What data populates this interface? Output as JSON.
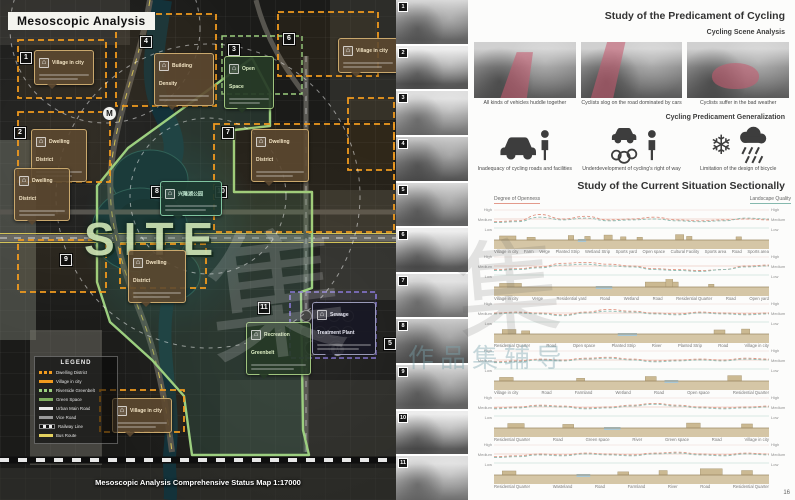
{
  "watermark": {
    "glyph": "集",
    "glyph2": "集",
    "text": "作品集辅导"
  },
  "page_number": "16",
  "map": {
    "title": "Mesoscopic Analysis",
    "site_label": "SITE",
    "metro_label": "M",
    "caption": "Mesoscopic Analysis Comprehensive Status Map  1:17000",
    "legend": {
      "title": "LEGEND",
      "items": [
        {
          "label": "Dwelling District",
          "swatch": "sw-orange-dash"
        },
        {
          "label": "Village in city",
          "swatch": "sw-orange"
        },
        {
          "label": "Riverside Greenbelt",
          "swatch": "sw-green-dash"
        },
        {
          "label": "Green Space",
          "swatch": "sw-green"
        },
        {
          "label": "Urban Main Road",
          "swatch": "sw-white"
        },
        {
          "label": "Vice Road",
          "swatch": "sw-gray"
        },
        {
          "label": "Railway Line",
          "swatch": "sw-rail"
        },
        {
          "label": "Bus Route",
          "swatch": "sw-yellow"
        }
      ]
    },
    "markers": [
      {
        "n": "1",
        "x": 20,
        "y": 52
      },
      {
        "n": "2",
        "x": 14,
        "y": 127
      },
      {
        "n": "3",
        "x": 228,
        "y": 44
      },
      {
        "n": "4",
        "x": 140,
        "y": 36
      },
      {
        "n": "5",
        "x": 384,
        "y": 338
      },
      {
        "n": "6",
        "x": 283,
        "y": 33
      },
      {
        "n": "7",
        "x": 222,
        "y": 127
      },
      {
        "n": "8",
        "x": 151,
        "y": 186
      },
      {
        "n": "9",
        "x": 60,
        "y": 254
      },
      {
        "n": "10",
        "x": 215,
        "y": 186
      },
      {
        "n": "11",
        "x": 258,
        "y": 302
      }
    ],
    "callouts": [
      {
        "t": "Village in city",
        "v": "brown",
        "x": 34,
        "y": 50,
        "w": 50
      },
      {
        "t": "Building Density",
        "v": "brown",
        "x": 154,
        "y": 53,
        "w": 50
      },
      {
        "t": "Open Space",
        "v": "green",
        "x": 224,
        "y": 56,
        "w": 40
      },
      {
        "t": "Village in city",
        "v": "brown",
        "x": 338,
        "y": 38,
        "w": 50
      },
      {
        "t": "Dwelling District",
        "v": "brown",
        "x": 251,
        "y": 129,
        "w": 48
      },
      {
        "t": "Dwelling District",
        "v": "brown",
        "x": 31,
        "y": 129,
        "w": 46
      },
      {
        "t": "Dwelling District",
        "v": "brown",
        "x": 14,
        "y": 168,
        "w": 46
      },
      {
        "t": "兴隆湖公园",
        "v": "jade",
        "x": 160,
        "y": 181,
        "w": 52
      },
      {
        "t": "Dwelling District",
        "v": "brown",
        "x": 128,
        "y": 250,
        "w": 48
      },
      {
        "t": "Recreation Greenbelt",
        "v": "green",
        "x": 246,
        "y": 322,
        "w": 55
      },
      {
        "t": "Sewage Treatment Plant",
        "v": "dark",
        "x": 312,
        "y": 302,
        "w": 54
      },
      {
        "t": "Village in city",
        "v": "brown",
        "x": 112,
        "y": 398,
        "w": 50
      }
    ]
  },
  "photo_strip": {
    "photos": [
      "1",
      "2",
      "3",
      "4",
      "5",
      "6",
      "7",
      "8",
      "9",
      "10",
      "11"
    ]
  },
  "cycling": {
    "title": "Study of the Predicament of Cycling",
    "scene_subtitle": "Cycling Scene Analysis",
    "scenes": [
      {
        "caption": "All kinds of vehicles huddle together"
      },
      {
        "caption": "Cyclists slog on the road dominated by cars"
      },
      {
        "caption": "Cyclists suffer in the bad weather"
      }
    ],
    "generalization_subtitle": "Cycling Predicament Generalization",
    "predicaments": [
      {
        "icon": "car-pedestrian",
        "caption": "Inadequacy of cycling roads and facilities"
      },
      {
        "icon": "car-exhaust-pedestrian",
        "caption": "Underdevelopment of cycling's right of way"
      },
      {
        "icon": "snow-rain",
        "caption": "Limitation of the design of bicycle"
      }
    ]
  },
  "sections_panel": {
    "title": "Study of the Current Situation Sectionally",
    "left_axis": "Degree of Openness",
    "right_axis": "Landscape Quality",
    "levels": [
      "High",
      "Medium",
      "Low"
    ],
    "sections": [
      {
        "openness": [
          0.35,
          0.4,
          0.75,
          0.5,
          0.65,
          0.45,
          0.5,
          0.6,
          0.45,
          0.4,
          0.45,
          0.5,
          0.45
        ],
        "quality": [
          0.3,
          0.35,
          0.6,
          0.45,
          0.55,
          0.4,
          0.45,
          0.5,
          0.4,
          0.35,
          0.4,
          0.55,
          0.5
        ],
        "structures": [
          [
            0.02,
            0.06,
            0.45
          ],
          [
            0.12,
            0.03,
            0.3
          ],
          [
            0.27,
            0.02,
            0.5
          ],
          [
            0.33,
            0.02,
            0.4
          ],
          [
            0.4,
            0.03,
            0.55
          ],
          [
            0.46,
            0.02,
            0.35
          ],
          [
            0.52,
            0.02,
            0.3
          ],
          [
            0.66,
            0.03,
            0.6
          ],
          [
            0.7,
            0.02,
            0.4
          ],
          [
            0.88,
            0.02,
            0.35
          ]
        ],
        "water": [
          [
            0.305,
            0.03
          ]
        ],
        "labels": [
          "Village in city",
          "Farm",
          "Verge",
          "Planted Strip",
          "Wetland Strip",
          "Sports yard",
          "Open space",
          "Cultural Facility",
          "Sports area",
          "Road",
          "Sports area"
        ]
      },
      {
        "openness": [
          0.3,
          0.35,
          0.45,
          0.65,
          0.7,
          0.6,
          0.5,
          0.35,
          0.3,
          0.25,
          0.3,
          0.5,
          0.55
        ],
        "quality": [
          0.25,
          0.3,
          0.4,
          0.55,
          0.6,
          0.5,
          0.45,
          0.3,
          0.25,
          0.2,
          0.3,
          0.45,
          0.5
        ],
        "structures": [
          [
            0.02,
            0.08,
            0.4
          ],
          [
            0.55,
            0.12,
            0.55
          ],
          [
            0.625,
            0.025,
            1.0
          ],
          [
            0.78,
            0.02,
            0.3
          ]
        ],
        "water": [
          [
            0.37,
            0.06
          ]
        ],
        "labels": [
          "Village in city",
          "Verge",
          "Residential yard",
          "Road",
          "Wetland",
          "Road",
          "Residential Quarter",
          "Road",
          "Open yard"
        ]
      },
      {
        "openness": [
          0.5,
          0.55,
          0.5,
          0.4,
          0.55,
          0.7,
          0.6,
          0.5,
          0.45,
          0.55,
          0.5,
          0.45,
          0.5
        ],
        "quality": [
          0.45,
          0.5,
          0.45,
          0.35,
          0.5,
          0.6,
          0.55,
          0.45,
          0.4,
          0.5,
          0.45,
          0.4,
          0.45
        ],
        "structures": [
          [
            0.03,
            0.05,
            0.5
          ],
          [
            0.1,
            0.03,
            0.35
          ],
          [
            0.8,
            0.04,
            0.45
          ],
          [
            0.9,
            0.03,
            0.55
          ]
        ],
        "water": [
          [
            0.45,
            0.07
          ]
        ],
        "labels": [
          "Residential Quarter",
          "Road",
          "Open space",
          "Planted Strip",
          "River",
          "Planted Strip",
          "Road",
          "Village in city"
        ]
      },
      {
        "openness": [
          0.4,
          0.45,
          0.55,
          0.5,
          0.6,
          0.65,
          0.55,
          0.45,
          0.5,
          0.55,
          0.5,
          0.6,
          0.55
        ],
        "quality": [
          0.35,
          0.4,
          0.5,
          0.45,
          0.55,
          0.6,
          0.5,
          0.4,
          0.45,
          0.5,
          0.45,
          0.55,
          0.5
        ],
        "structures": [
          [
            0.02,
            0.05,
            0.4
          ],
          [
            0.3,
            0.03,
            0.3
          ],
          [
            0.55,
            0.04,
            0.5
          ],
          [
            0.85,
            0.05,
            0.6
          ]
        ],
        "water": [
          [
            0.62,
            0.05
          ]
        ],
        "labels": [
          "Village in city",
          "Road",
          "Farmland",
          "Wetland",
          "Road",
          "Open space",
          "Residential Quarter"
        ]
      },
      {
        "openness": [
          0.45,
          0.5,
          0.6,
          0.55,
          0.45,
          0.5,
          0.6,
          0.7,
          0.6,
          0.5,
          0.45,
          0.5,
          0.55
        ],
        "quality": [
          0.4,
          0.45,
          0.55,
          0.5,
          0.4,
          0.45,
          0.55,
          0.65,
          0.55,
          0.45,
          0.4,
          0.45,
          0.5
        ],
        "structures": [
          [
            0.05,
            0.06,
            0.5
          ],
          [
            0.25,
            0.04,
            0.4
          ],
          [
            0.7,
            0.05,
            0.55
          ],
          [
            0.9,
            0.04,
            0.45
          ]
        ],
        "water": [
          [
            0.4,
            0.06
          ]
        ],
        "labels": [
          "Residential Quarter",
          "Road",
          "Green space",
          "River",
          "Green space",
          "Road",
          "Village in city"
        ]
      },
      {
        "openness": [
          0.35,
          0.4,
          0.5,
          0.45,
          0.55,
          0.5,
          0.45,
          0.55,
          0.6,
          0.5,
          0.45,
          0.55,
          0.5
        ],
        "quality": [
          0.3,
          0.35,
          0.45,
          0.4,
          0.5,
          0.45,
          0.4,
          0.5,
          0.55,
          0.45,
          0.4,
          0.5,
          0.45
        ],
        "structures": [
          [
            0.03,
            0.05,
            0.45
          ],
          [
            0.45,
            0.04,
            0.35
          ],
          [
            0.6,
            0.03,
            0.5
          ],
          [
            0.75,
            0.08,
            0.7
          ],
          [
            0.9,
            0.04,
            0.5
          ]
        ],
        "water": [
          [
            0.3,
            0.05
          ]
        ],
        "labels": [
          "Residential Quarter",
          "Wasteland",
          "Road",
          "Farmland",
          "River",
          "Road",
          "Residential Quarter"
        ]
      }
    ]
  }
}
